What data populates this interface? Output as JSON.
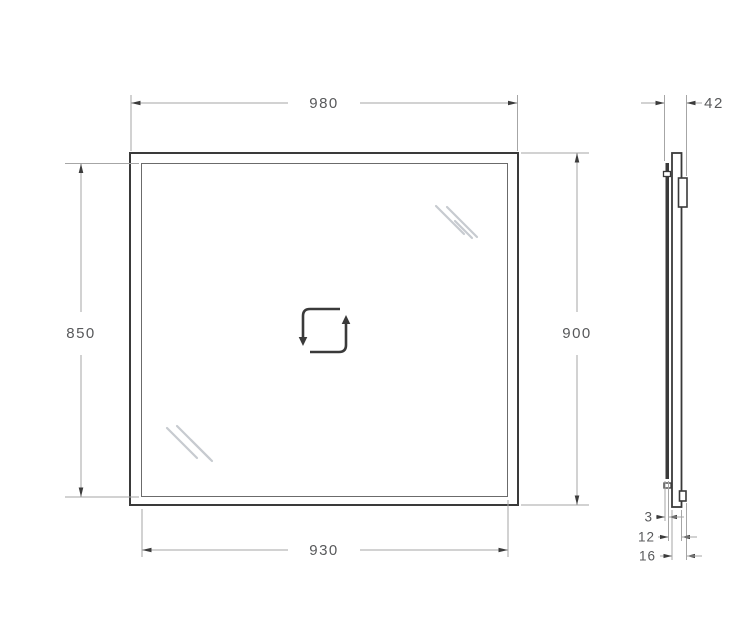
{
  "document": {
    "type": "technical-dimension-drawing",
    "subject": "rectangular mirror, front elevation and side profile"
  },
  "dimensions": {
    "front": {
      "width_top": "980",
      "height_left": "850",
      "height_right": "900",
      "width_bottom": "930"
    },
    "side": {
      "depth_top": "42",
      "stack": [
        "3",
        "12",
        "16"
      ]
    }
  },
  "icons": {
    "center_icon": "rotate-square-icon",
    "shine_marks": "glass-shine-lines"
  },
  "colors": {
    "outline": "#3a3a3a",
    "inner_edge": "#6b6b6b",
    "dim_line": "#a6a6a6",
    "arrow": "#3c3c3c",
    "text": "#58595b",
    "shine": "#c7cbd0",
    "background": "#ffffff"
  }
}
